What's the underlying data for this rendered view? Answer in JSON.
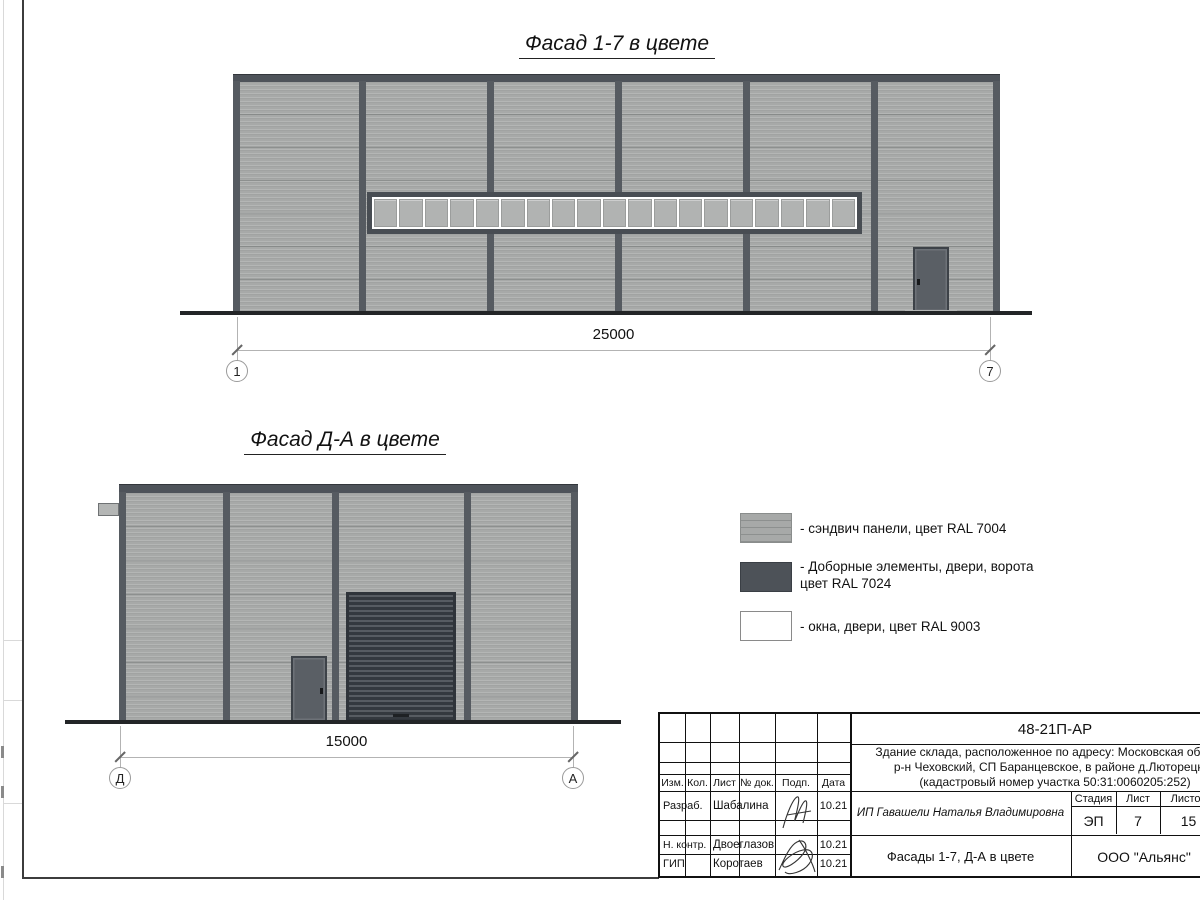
{
  "facade1": {
    "title": "Фасад 1-7 в цвете",
    "dimension": "25000",
    "axis_left": "1",
    "axis_right": "7",
    "window_pane_count": 19
  },
  "facade2": {
    "title": "Фасад Д-А в цвете",
    "dimension": "15000",
    "axis_left": "Д",
    "axis_right": "А"
  },
  "legend": {
    "items": [
      {
        "label": "- сэндвич панели, цвет RAL 7004"
      },
      {
        "label": "- Доборные элементы, двери, ворота",
        "label2": "цвет RAL 7024"
      },
      {
        "label": "- окна, двери, цвет RAL 9003"
      }
    ]
  },
  "colors": {
    "panels_ral7004": "#a7a9a8",
    "trim_ral7024": "#4d5258",
    "windows_ral9003": "#ffffff"
  },
  "titleblock": {
    "doc_number": "48-21П-АР",
    "description_line1": "Здание склада, расположенное по адресу: Московская область,",
    "description_line2": "р-н Чеховский, СП Баранцевское, в районе д.Люторецкое",
    "description_line3": "(кадастровый номер участка 50:31:0060205:252)",
    "columns": {
      "izm": "Изм.",
      "kol": "Кол.",
      "list": "Лист",
      "doc": "№ док.",
      "podp": "Подп.",
      "data": "Дата"
    },
    "rows": [
      {
        "role": "Разраб.",
        "name": "Шабалина",
        "date": "10.21"
      },
      {
        "role": "Н. контр.",
        "name": "Двоеглазов",
        "date": "10.21"
      },
      {
        "role": "ГИП",
        "name": "Коротаев",
        "date": "10.21"
      }
    ],
    "customer": "ИП Гавашели Наталья Владимировна",
    "sheet_title": "Фасады 1-7, Д-А в цвете",
    "stage_label": "Стадия",
    "stage": "ЭП",
    "sheet_label": "Лист",
    "sheet": "7",
    "sheets_label": "Листов",
    "sheets": "15",
    "company": "ООО \"Альянс\""
  }
}
